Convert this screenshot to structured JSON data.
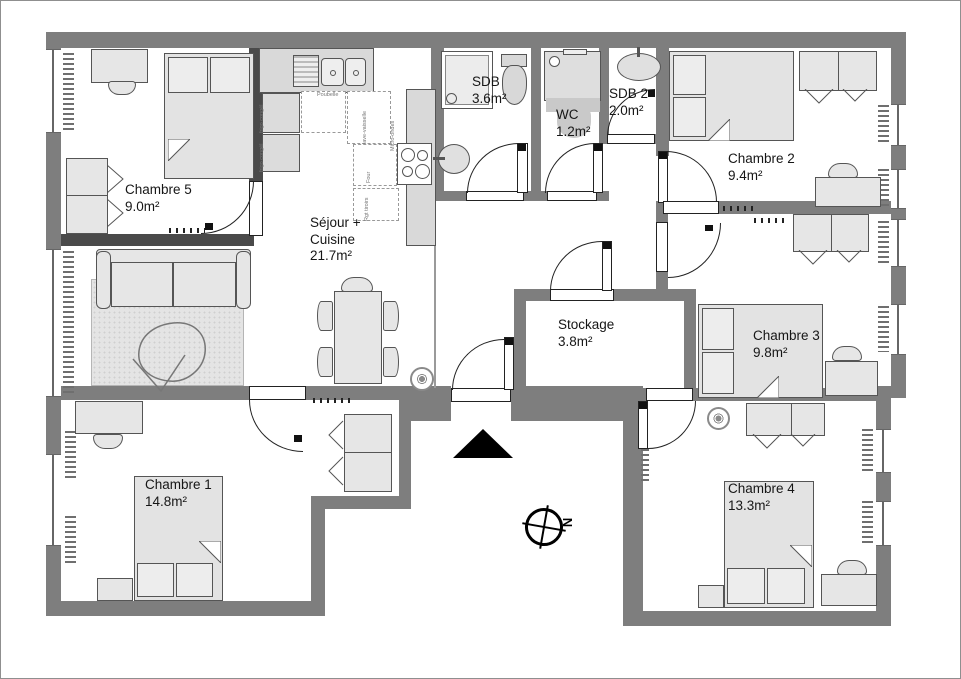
{
  "plan": {
    "rooms": [
      {
        "name": "Chambre 5",
        "area": "9.0m²"
      },
      {
        "name": "Séjour +",
        "name2": "Cuisine",
        "area": "21.7m²"
      },
      {
        "name": "SDB",
        "area": "3.6m²"
      },
      {
        "name": "WC",
        "area": "1.2m²"
      },
      {
        "name": "SDB 2",
        "area": "2.0m²"
      },
      {
        "name": "Chambre 2",
        "area": "9.4m²"
      },
      {
        "name": "Chambre 3",
        "area": "9.8m²"
      },
      {
        "name": "Stockage",
        "area": "3.8m²"
      },
      {
        "name": "Chambre 1",
        "area": "14.8m²"
      },
      {
        "name": "Chambre 4",
        "area": "13.3m²"
      }
    ],
    "kitchen_labels": {
      "trash": "Poubelle",
      "oven": "Four",
      "microwave": "Micro-ondes",
      "fridge_top": "frigo congél",
      "fridge_bottom": "frigo congél",
      "dishwasher": "lave-vaisselle",
      "storage": "Rgt tiroirs"
    },
    "compass": {
      "north_label": "N"
    },
    "colors": {
      "wall": "#7e7e7e",
      "dark_wall": "#4a4a4a",
      "furniture": "#e6e6e6",
      "floor": "#ffffff"
    }
  }
}
